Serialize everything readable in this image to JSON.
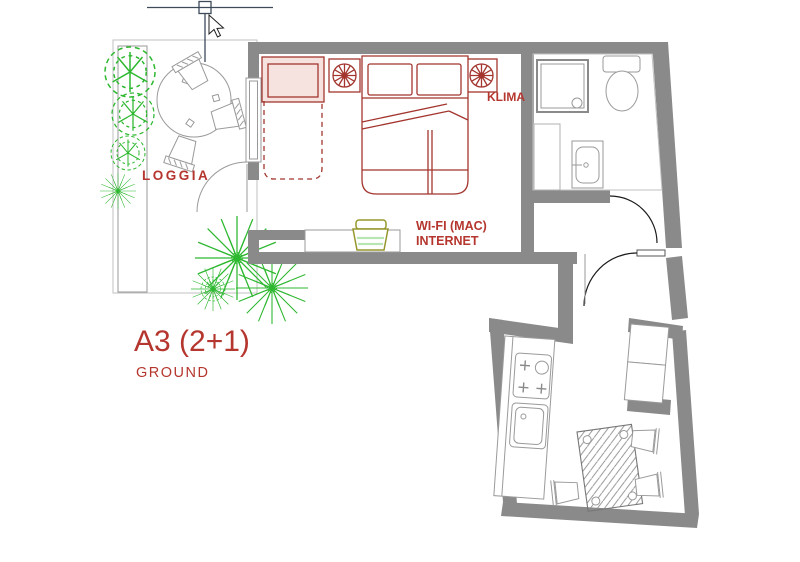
{
  "labels": {
    "loggia": "LOGGIA",
    "klima": "KLIMA",
    "wifi_line1": "WI-FI (MAC)",
    "wifi_line2": "INTERNET",
    "unit": "A3 (2+1)",
    "floor": "GROUND"
  },
  "colors": {
    "wall": "#8a8a8a",
    "furniture_red": "#a3352e",
    "label_red": "#b5362e",
    "plant_green": "#2eb830",
    "line_gray": "#9a9a9a",
    "tile_gray": "#c2c2c2",
    "door_dark": "#1c1c1c",
    "cursor": "#3d4a5a",
    "router_olive": "#97972e",
    "router_band": "#b9e4b4",
    "bed_pink": "#f6e3e0"
  },
  "icons": {
    "crosshair_cursor": "cad-crosshair",
    "pointer_cursor": "arrow",
    "ac_fan": "rosette-fan",
    "wifi_router": "router-dome",
    "plants": "bush-and-palm"
  }
}
